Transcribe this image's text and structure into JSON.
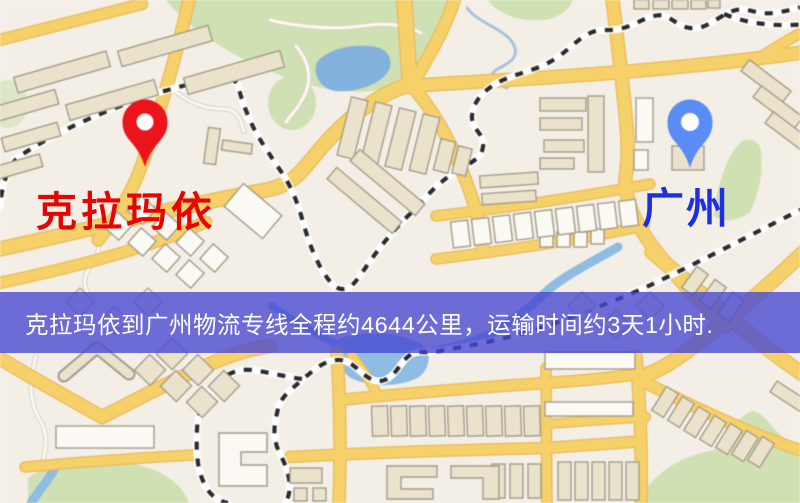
{
  "map": {
    "origin": {
      "label": "克拉玛依",
      "label_color": "#e60400",
      "pin_color": "#e9151b"
    },
    "destination": {
      "label": "广州",
      "label_color": "#1c2fe4",
      "pin_color": "#5a8df3"
    }
  },
  "banner": {
    "text": "克拉玛依到广州物流专线全程约4644公里，运输时间约3天1小时.",
    "text_color": "#ffffff",
    "background_color": "rgba(70,70,210,0.78)"
  },
  "palette": {
    "map_background": "#f3efe6",
    "road_yellow": "#f5d06b",
    "road_casing": "#e9b95c",
    "minor_road": "#fbf9f3",
    "minor_casing": "#d9d2c5",
    "park_green": "#cfe0b4",
    "water_blue": "#8fbce2",
    "lake_blue": "#85b2dd",
    "railway_black": "#2b2b2b",
    "building_fill": "#eae2cb",
    "building_white": "#fbf9f4",
    "building_stroke": "#a49c8a"
  }
}
